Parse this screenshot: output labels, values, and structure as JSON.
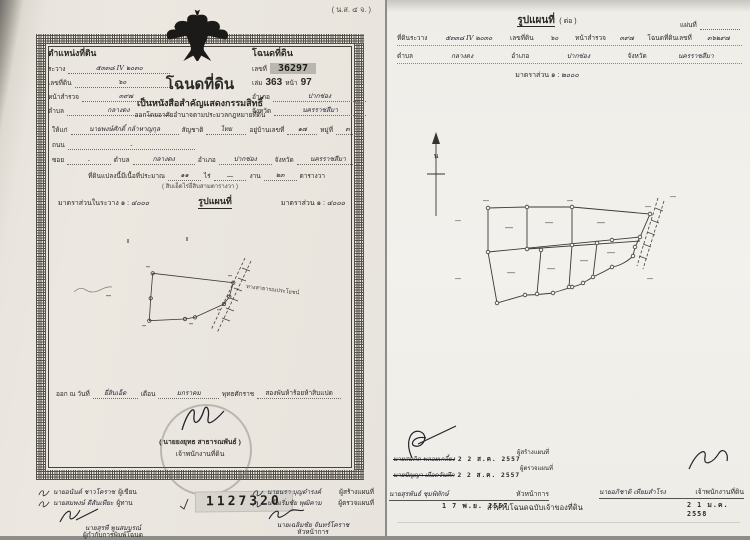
{
  "colors": {
    "paper_left": "#eae6df",
    "paper_right": "#f3f1ec",
    "ink": "#2b2a26",
    "stamp_bg": "#b9b6ae",
    "gap_gray": "#8e8d89"
  },
  "left_doc": {
    "form_code": "( น.ส. ๔ จ. )",
    "position_block": {
      "title": "ตำแหน่งที่ดิน",
      "fields": [
        {
          "label": "ระวาง",
          "value": "๕๓๓๘ IV ๒๐๓๐"
        },
        {
          "label": "เลขที่ดิน",
          "value": "๖๐"
        },
        {
          "label": "หน้าสำรวจ",
          "value": "๓๙๗"
        },
        {
          "label": "ตำบล",
          "value": "กลางดง"
        }
      ]
    },
    "deed_box": {
      "title": "โฉนดที่ดิน",
      "no_label": "เลขที่",
      "no_value": "36297",
      "book_label": "เล่ม",
      "book_value": "363",
      "page_label": "หน้า",
      "page_value": "97",
      "amphoe_label": "อำเภอ",
      "amphoe_value": "ปากช่อง",
      "province_label": "จังหวัด",
      "province_value": "นครราชสีมา"
    },
    "title": "โฉนดที่ดิน",
    "subtitle": "เป็นหนังสือสำคัญแสดงกรรมสิทธิ์",
    "law_line": "ออกโดยอาศัยอำนาจตามประมวลกฎหมายที่ดิน",
    "grantee": {
      "label": "ให้แก่",
      "name": "นายพงษ์ศักดิ์ กล้าหาญกุล",
      "nat_label": "สัญชาติ",
      "nat_value": "ไทย",
      "addr_label": "อยู่บ้านเลขที่",
      "addr_value": "๑๗",
      "moo_label": "หมู่ที่",
      "moo_value": "๓"
    },
    "road_label": "ถนน",
    "road_value": "-",
    "soi_line": {
      "label": "ซอย",
      "value": "-",
      "tambon_label": "ตำบล",
      "tambon_value": "กลางดง",
      "amphoe_label": "อำเภอ",
      "amphoe_value": "ปากช่อง",
      "province_label": "จังหวัด",
      "province_value": "นครราชสีมา"
    },
    "area_line": {
      "prefix": "ที่ดินแปลงนี้มีเนื้อที่ประมาณ",
      "rai_value": "๑๑",
      "rai_label": "ไร่",
      "ngan_value": "—",
      "ngan_label": "งาน",
      "wa_value": "๒๓",
      "wa_label": "ตารางวา",
      "in_words": "( สิบเอ็ดไร่ยี่สิบสามตารางวา )"
    },
    "scales": {
      "left_label": "มาตราส่วนในระวาง ๑ :",
      "left_value": "๔๐๐๐",
      "heading": "รูปแผนที่",
      "right_label": "มาตราส่วน ๑ :",
      "right_value": "๔๐๐๐"
    },
    "map": {
      "road_label": "ทางสาธารณประโยชน์"
    },
    "issue_line": {
      "prefix": "ออก ณ วันที่",
      "day_value": "ยี่สิบเอ็ด",
      "month_label": "เดือน",
      "month_value": "มกราคม",
      "era_label": "พุทธศักราช",
      "era_value": "สองพันห้าร้อยห้าสิบแปด"
    },
    "seal": {
      "signer": "( นายยงยุทธ สาธารณพันธ์ )",
      "role": "เจ้าพนักงานที่ดิน"
    },
    "footer": {
      "left_rows": [
        {
          "name": "นายอนันต์ ชาวโคราช",
          "role": "ผู้เขียน"
        },
        {
          "name": "นายสมพงษ์ ดีสันเทียะ",
          "role": "ผู้ทาน"
        }
      ],
      "left_chief": {
        "name": "นายสุรพี พูนสมบูรณ์",
        "role": "ผู้กำกับการพิมพ์โฉนด"
      },
      "serial": "1127320",
      "right_rows": [
        {
          "name": "นายนรา บุญดำรงค์",
          "role": "ผู้สร้างแผนที่"
        },
        {
          "name": "นายเริ่มชัย พุฒิคาม",
          "role": "ผู้ตรวจแผนที่"
        }
      ],
      "right_chief": {
        "name": "นายเฉลิมชัย จันทร์โคราช",
        "role": "หัวหน้าการ"
      }
    }
  },
  "right_doc": {
    "title": "รูปแผนที่",
    "title_suffix": "( ต่อ )",
    "sheet_label": "แผ่นที่",
    "line1": [
      {
        "label": "ที่ดินระวาง",
        "value": "๕๓๓๘ IV ๒๐๓๐"
      },
      {
        "label": "เลขที่ดิน",
        "value": "๖๐"
      },
      {
        "label": "หน้าสำรวจ",
        "value": "๓๙๗"
      },
      {
        "label": "โฉนดที่ดินเลขที่",
        "value": "๓๖๒๙๗"
      }
    ],
    "line2": [
      {
        "label": "ตำบล",
        "value": "กลางดง"
      },
      {
        "label": "อำเภอ",
        "value": "ปากช่อง"
      },
      {
        "label": "จังหวัด",
        "value": "นครราชสีมา"
      }
    ],
    "scale_label": "มาตราส่วน ๑ :",
    "scale_value": "๒๐๐๐",
    "north_label": "น",
    "signatures": [
      {
        "name": "นายสมคิด พลอยเกลี้ยง",
        "role": "ผู้สร้างแผนที่",
        "date": "2 2 ส.ค. 2557"
      },
      {
        "name": "นายปัญญา เผือดจันทึก",
        "role": "ผู้ตรวจแผนที่",
        "date": "2 2 ส.ค. 2557"
      },
      {
        "name": "นายสุรพันธ์ ชุมพิทักษ์",
        "role": "หัวหน้าการ",
        "date": "1 7 พ.ย. 2557"
      }
    ],
    "officer": {
      "name": "นายอภิชาติ เทียมสำโรง",
      "role": "เจ้าพนักงานที่ดิน",
      "date": "2 1 ม.ค. 2558"
    },
    "owner_note": "สำหรับโฉนดฉบับเจ้าของที่ดิน"
  }
}
